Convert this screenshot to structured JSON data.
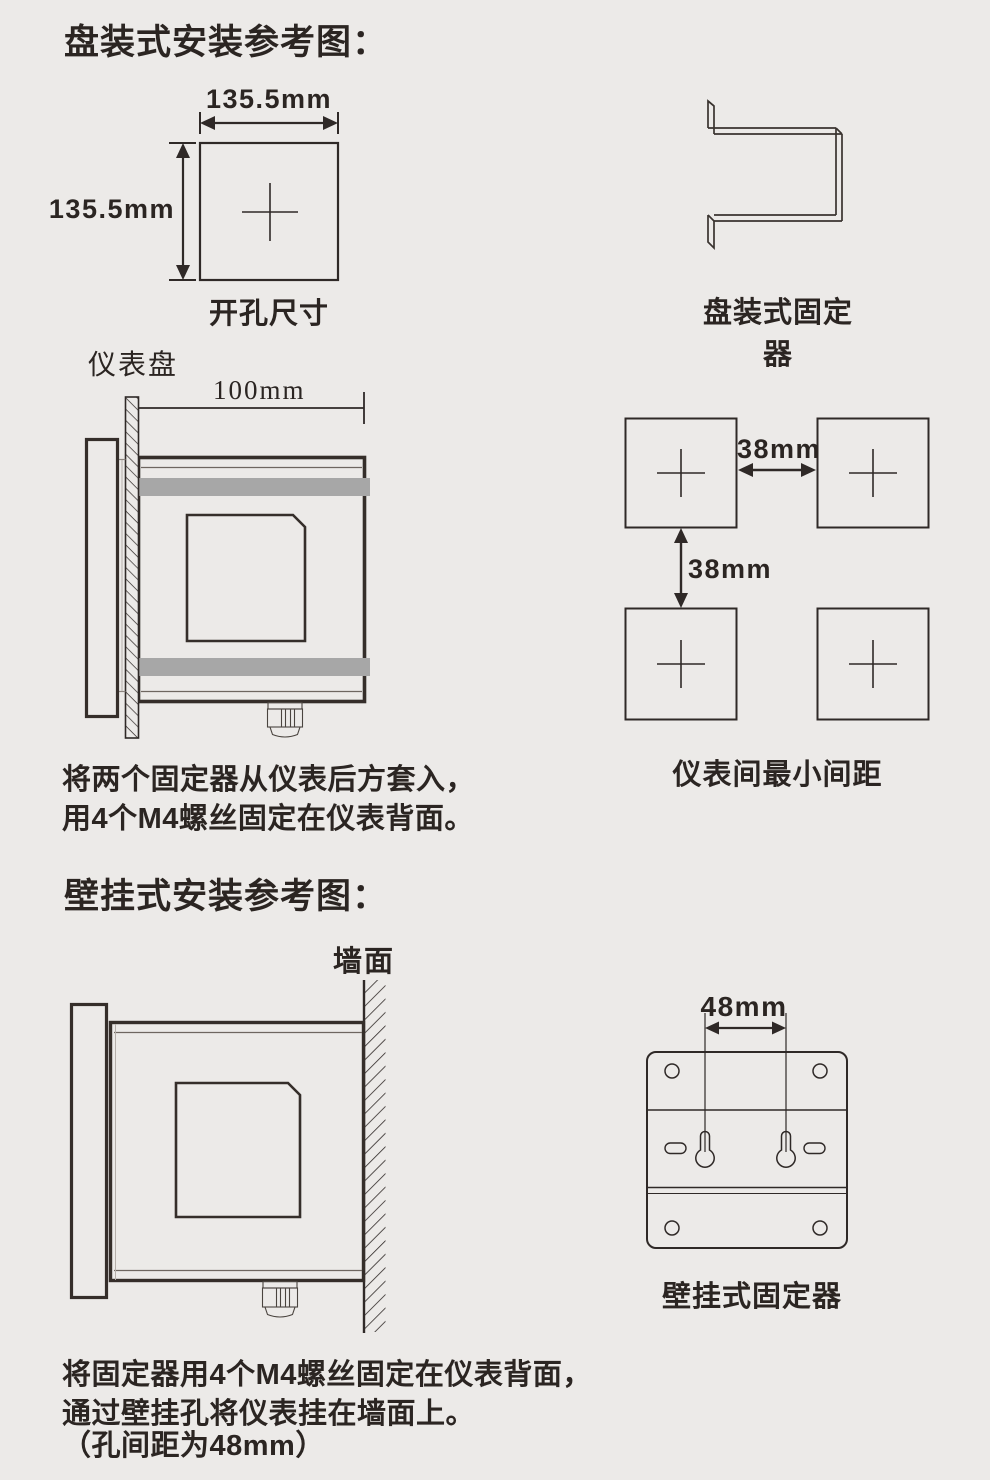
{
  "panel": {
    "title": "盘装式安装参考图：",
    "cutout": {
      "width_label": "135.5mm",
      "height_label": "135.5mm",
      "caption": "开孔尺寸"
    },
    "bracket_caption": "盘装式固定器",
    "side_view": {
      "panel_label": "仪表盘",
      "depth_label": "100mm"
    },
    "spacing": {
      "h_label": "38mm",
      "v_label": "38mm",
      "caption": "仪表间最小间距"
    },
    "note1": "将两个固定器从仪表后方套入，",
    "note2": "用4个M4螺丝固定在仪表背面。"
  },
  "wall": {
    "title": "壁挂式安装参考图：",
    "wall_label": "墙面",
    "dim_label": "48mm",
    "caption": "壁挂式固定器",
    "note1": "将固定器用4个M4螺丝固定在仪表背面，",
    "note2": "通过壁挂孔将仪表挂在墙面上。",
    "note3": "（孔间距为48mm）"
  },
  "colors": {
    "background": "#eceae8",
    "ink": "#2f2927",
    "bracket_gray": "#a7a7a7"
  }
}
